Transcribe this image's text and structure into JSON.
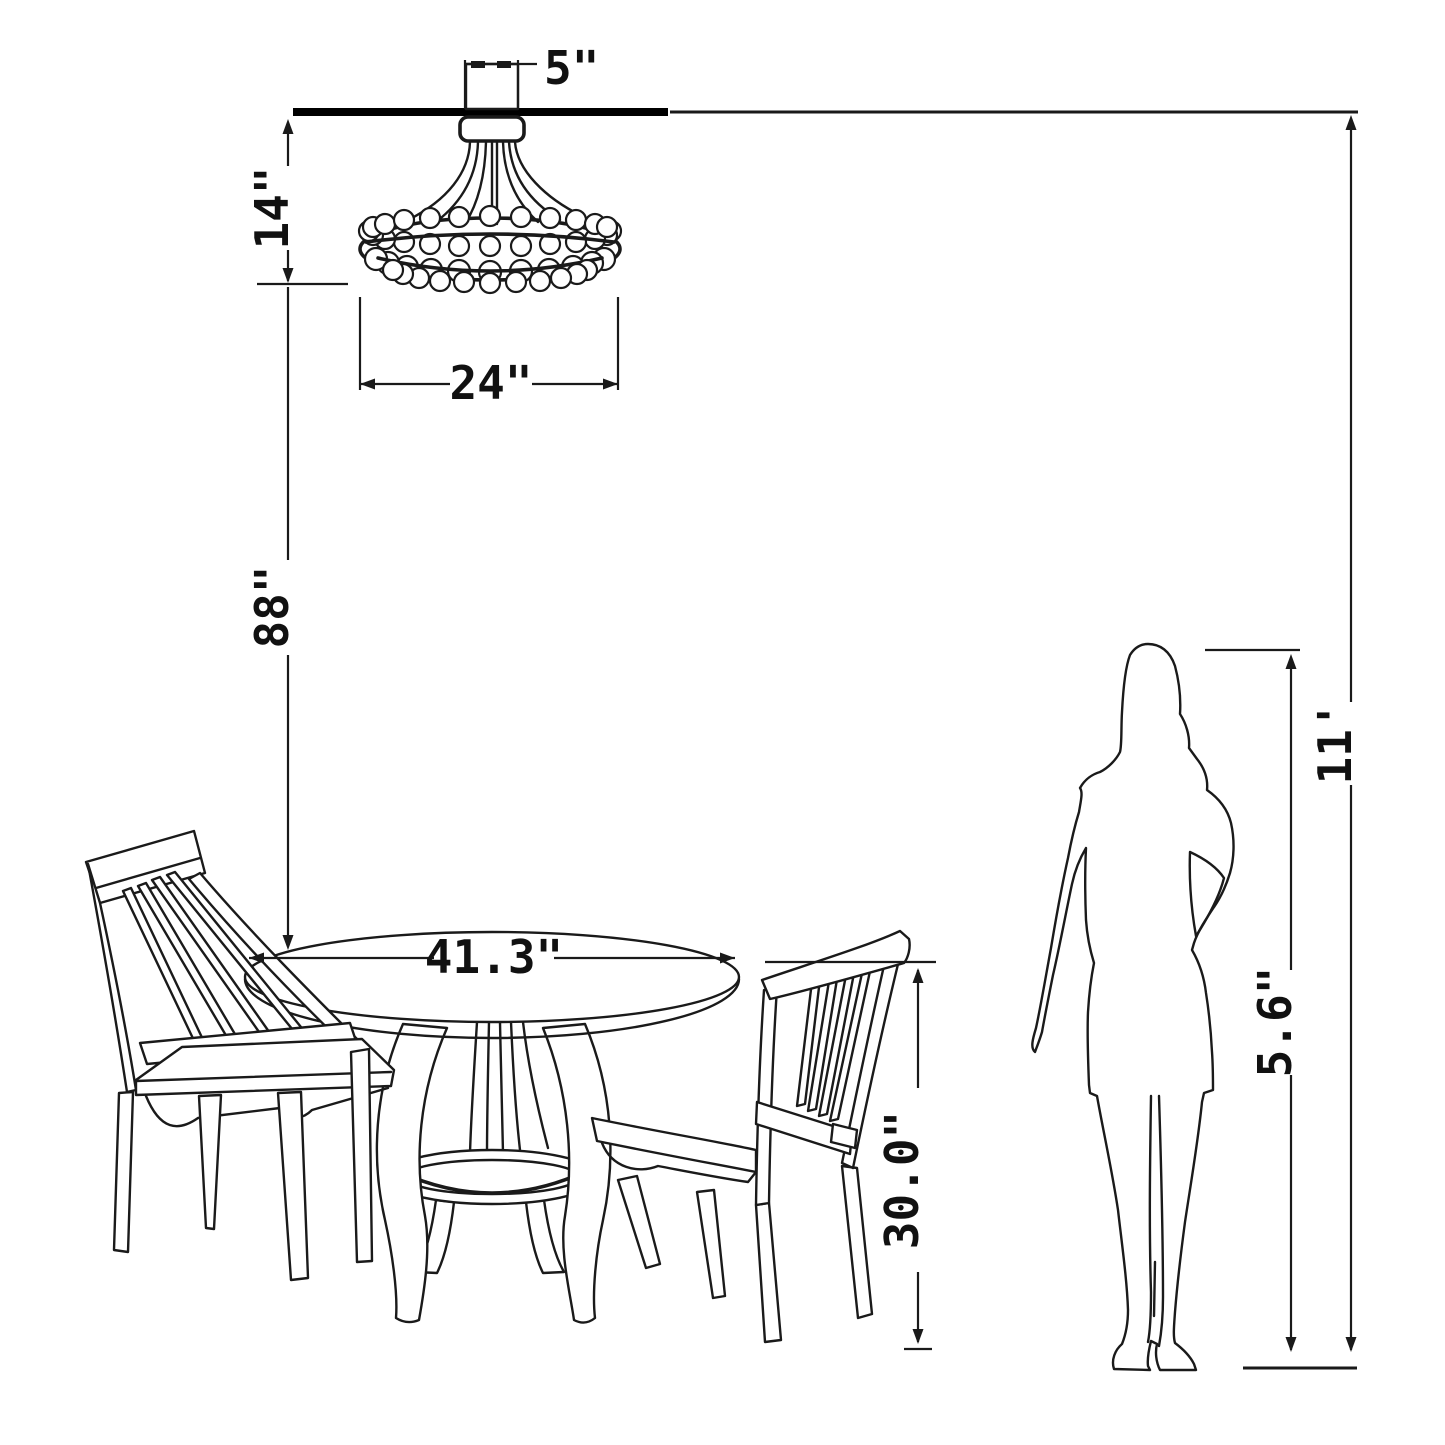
{
  "diagram": {
    "subject": "dining-set-and-chandelier-clearance-diagram",
    "background_color": "#ffffff",
    "line_color": "#1a1a1a"
  },
  "labels": {
    "canopy_width": "5\"",
    "fixture_height": "14\"",
    "fixture_diameter": "24\"",
    "hanging_clearance": "88\"",
    "table_diameter": "41.3\"",
    "table_height": "30.0\"",
    "person_height": "5.6\"",
    "ceiling_height": "11'"
  }
}
